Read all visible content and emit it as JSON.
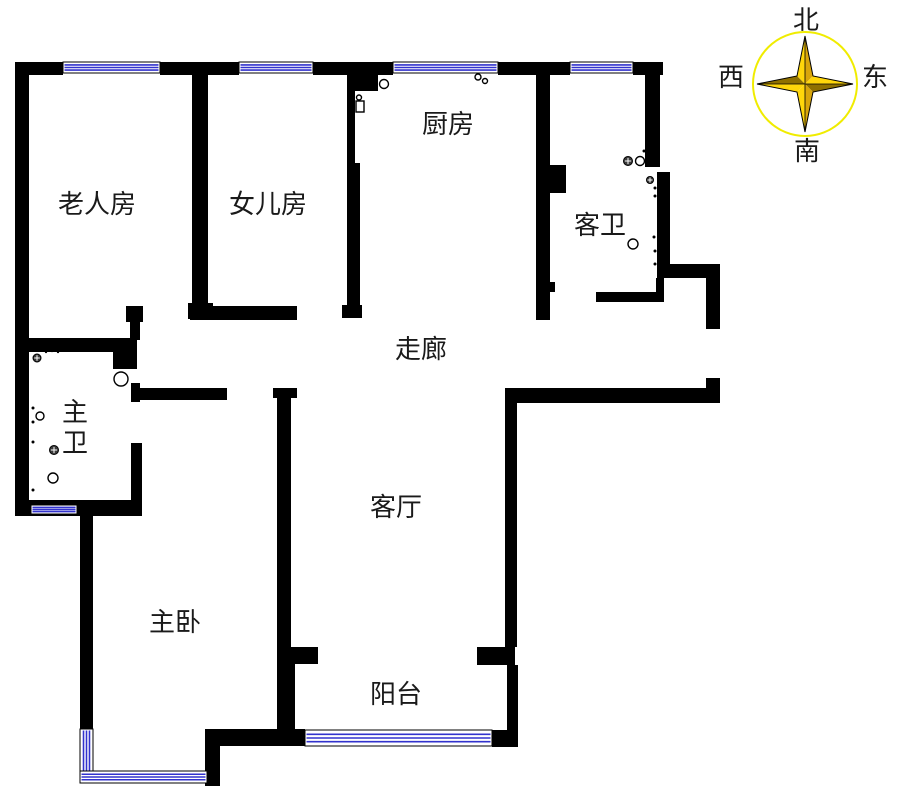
{
  "rooms": {
    "elder_room": {
      "label": "老人房"
    },
    "daughter_room": {
      "label": "女儿房"
    },
    "kitchen": {
      "label": "厨房"
    },
    "guest_bathroom": {
      "label": "客卫"
    },
    "corridor": {
      "label": "走廊"
    },
    "master_bathroom": {
      "label": "主卫"
    },
    "living_room": {
      "label": "客厅"
    },
    "master_bedroom": {
      "label": "主卧"
    },
    "balcony": {
      "label": "阳台"
    }
  },
  "compass": {
    "north": "北",
    "south": "南",
    "west": "西",
    "east": "东"
  },
  "colors": {
    "wall": "#000000",
    "window": "#3232cd",
    "compass_ring": "#f0ec00",
    "star_light": "#ffd60a",
    "star_gold": "#d9a60b",
    "star_dark": "#8f7000",
    "text": "#1a1a1a"
  }
}
